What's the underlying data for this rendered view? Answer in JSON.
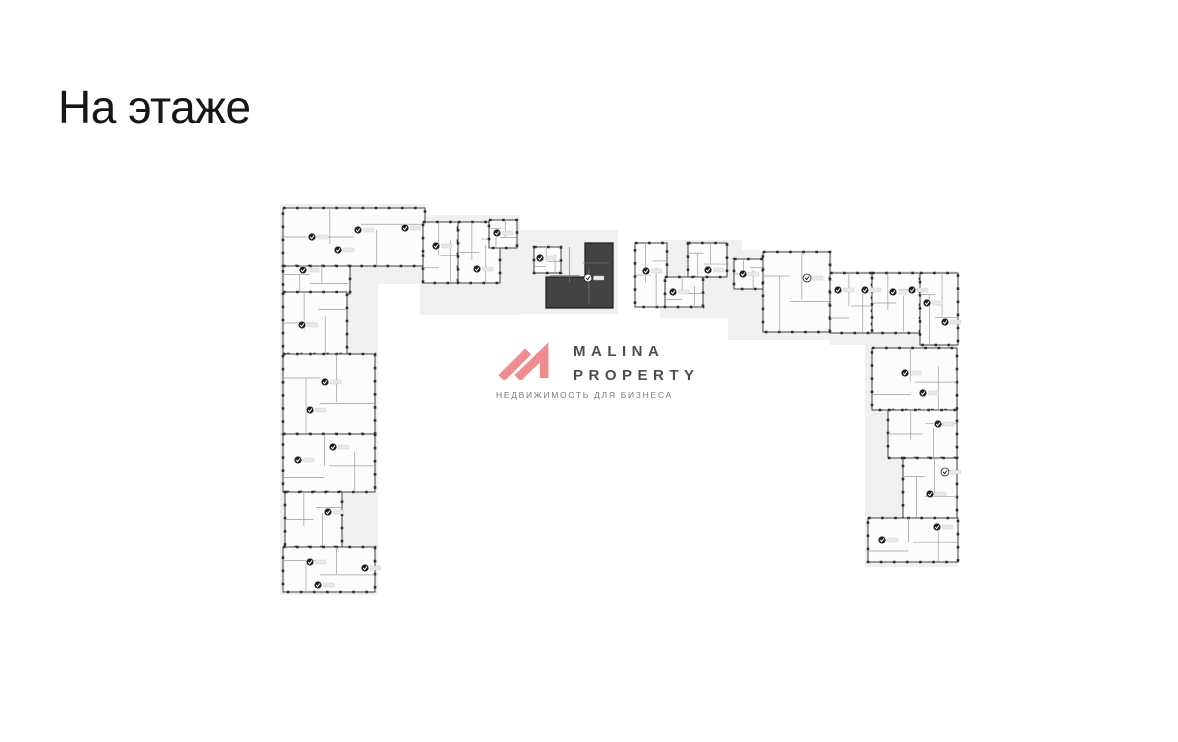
{
  "page": {
    "title": "На этаже",
    "title_color": "#161616",
    "background": "#ffffff"
  },
  "logo": {
    "line1": "MALINA",
    "line2": "PROPERTY",
    "tagline": "НЕДВИЖИМОСТЬ ДЛЯ БИЗНЕСА",
    "mark_color": "#ed8c8c",
    "text_color": "#4a4d52",
    "tagline_color": "#75787d"
  },
  "floorplan": {
    "colors": {
      "plate": "#f0f0f0",
      "unit_fill": "#fcfcfc",
      "wall": "#3f3f3f",
      "inner_wall": "#9b9b9b",
      "tick": "#2e2e2e",
      "selected_fill": "#434343",
      "selected_wall": "#1e1e1e",
      "selected_inner": "#7d7d7d",
      "badge_dark": "#1f1f1f",
      "badge_light": "#ffffff",
      "label_stub": "#e9e9e9",
      "label_stub_border": "#c6c6c6"
    },
    "area": {
      "x": 270,
      "y": 192,
      "width": 695,
      "height": 425
    },
    "plates": [
      [
        280,
        204,
        145,
        80
      ],
      [
        280,
        284,
        98,
        311
      ],
      [
        420,
        215,
        100,
        100
      ],
      [
        505,
        230,
        113,
        84
      ],
      [
        660,
        240,
        82,
        78
      ],
      [
        728,
        250,
        104,
        90
      ],
      [
        830,
        271,
        128,
        74
      ],
      [
        865,
        345,
        93,
        222
      ]
    ],
    "units": [
      [
        283,
        208,
        142,
        58
      ],
      [
        283,
        266,
        67,
        28
      ],
      [
        423,
        222,
        35,
        61
      ],
      [
        458,
        222,
        42,
        61
      ],
      [
        489,
        220,
        28,
        28
      ],
      [
        534,
        247,
        27,
        26
      ],
      [
        635,
        243,
        32,
        64
      ],
      [
        688,
        243,
        39,
        34
      ],
      [
        665,
        277,
        38,
        30
      ],
      [
        734,
        259,
        29,
        30
      ],
      [
        763,
        252,
        67,
        80
      ],
      [
        830,
        273,
        42,
        60
      ],
      [
        872,
        273,
        48,
        60
      ],
      [
        920,
        273,
        38,
        72
      ],
      [
        872,
        348,
        85,
        62
      ],
      [
        888,
        410,
        69,
        48
      ],
      [
        903,
        458,
        54,
        62
      ],
      [
        868,
        518,
        90,
        44
      ],
      [
        283,
        292,
        64,
        62
      ],
      [
        283,
        354,
        92,
        80
      ],
      [
        283,
        434,
        92,
        58
      ],
      [
        285,
        492,
        57,
        55
      ],
      [
        283,
        547,
        92,
        45
      ]
    ],
    "selected_unit": {
      "polygon": [
        [
          585,
          243
        ],
        [
          613,
          243
        ],
        [
          613,
          308
        ],
        [
          546,
          308
        ],
        [
          546,
          277
        ],
        [
          585,
          277
        ]
      ],
      "badge": [
        588,
        278
      ]
    },
    "badges": [
      [
        312,
        237,
        "d"
      ],
      [
        358,
        230,
        "d"
      ],
      [
        405,
        228,
        "d"
      ],
      [
        338,
        250,
        "d"
      ],
      [
        303,
        270,
        "d"
      ],
      [
        436,
        246,
        "d"
      ],
      [
        477,
        269,
        "d"
      ],
      [
        497,
        233,
        "d"
      ],
      [
        540,
        258,
        "d"
      ],
      [
        646,
        271,
        "d"
      ],
      [
        708,
        270,
        "d"
      ],
      [
        673,
        292,
        "d"
      ],
      [
        743,
        274,
        "d"
      ],
      [
        807,
        278,
        "l"
      ],
      [
        838,
        290,
        "d"
      ],
      [
        865,
        290,
        "d"
      ],
      [
        893,
        292,
        "d"
      ],
      [
        912,
        290,
        "d"
      ],
      [
        927,
        303,
        "d"
      ],
      [
        945,
        322,
        "d"
      ],
      [
        905,
        373,
        "d"
      ],
      [
        923,
        393,
        "d"
      ],
      [
        938,
        424,
        "d"
      ],
      [
        945,
        472,
        "l"
      ],
      [
        930,
        494,
        "d"
      ],
      [
        882,
        540,
        "d"
      ],
      [
        937,
        527,
        "d"
      ],
      [
        302,
        325,
        "d"
      ],
      [
        325,
        382,
        "d"
      ],
      [
        310,
        410,
        "d"
      ],
      [
        333,
        447,
        "d"
      ],
      [
        298,
        460,
        "d"
      ],
      [
        328,
        512,
        "d"
      ],
      [
        310,
        562,
        "d"
      ],
      [
        318,
        585,
        "d"
      ],
      [
        365,
        568,
        "d"
      ]
    ]
  }
}
